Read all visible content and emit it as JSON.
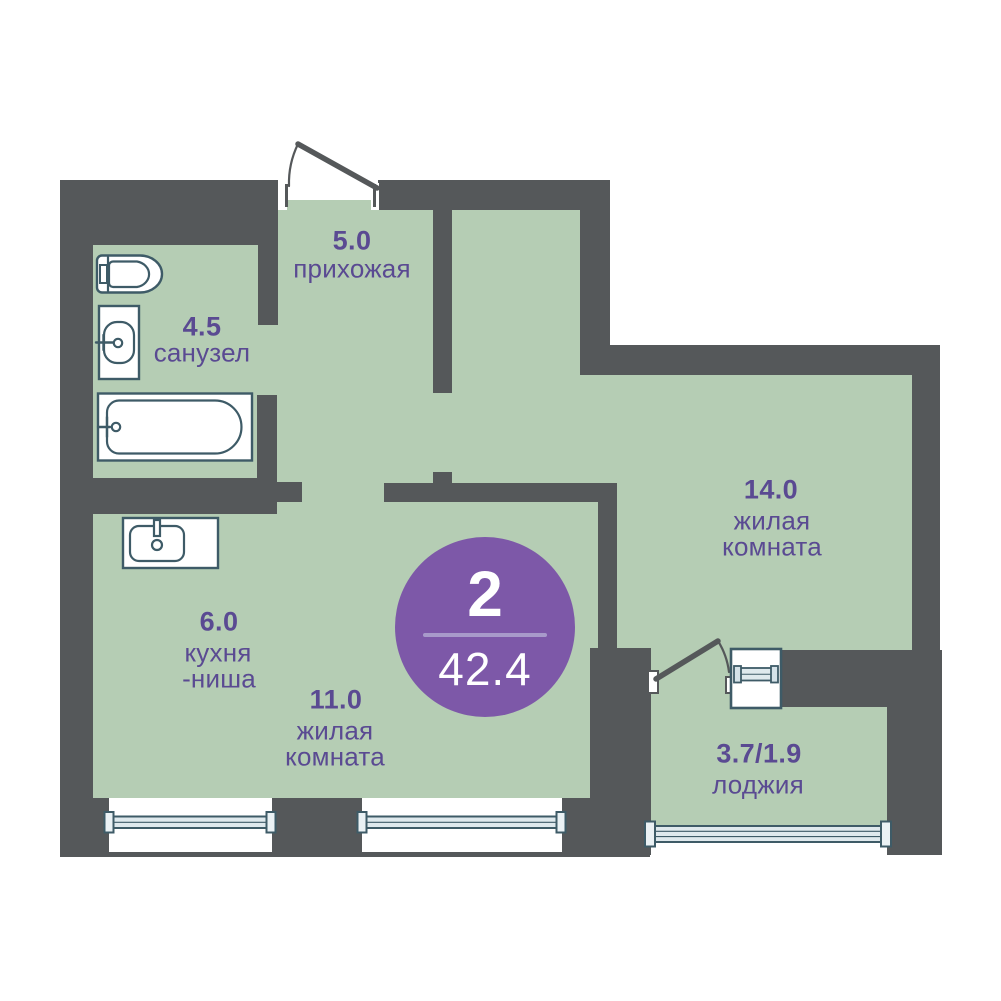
{
  "badge": {
    "rooms": "2",
    "area": "42.4"
  },
  "rooms": {
    "hallway": {
      "area": "5.0",
      "name": "прихожая"
    },
    "bathroom": {
      "area": "4.5",
      "name": "санузел"
    },
    "living1": {
      "area": "14.0",
      "line1": "жилая",
      "line2": "комната"
    },
    "kitchen": {
      "area": "6.0",
      "line1": "кухня",
      "line2": "-ниша"
    },
    "living2": {
      "area": "11.0",
      "line1": "жилая",
      "line2": "комната"
    },
    "loggia": {
      "area": "3.7/1.9",
      "name": "лоджия"
    }
  },
  "icons": {
    "toilet": "toilet-icon",
    "bathroom_sink": "sink-icon",
    "bathtub": "bathtub-icon",
    "kitchen_sink": "kitchen-sink-icon",
    "entrance_door": "door-swing-icon",
    "loggia_door": "door-swing-icon",
    "window": "window-icon"
  },
  "colors": {
    "floor": "#b5cdb4",
    "wall": "#55585a",
    "fixture_outline": "#3e5b67",
    "window_fill": "#dfe9ed",
    "label": "#5a4a92",
    "badge_bg": "#7d58a8",
    "badge_divider": "#a89aca",
    "badge_text": "#ffffff"
  }
}
